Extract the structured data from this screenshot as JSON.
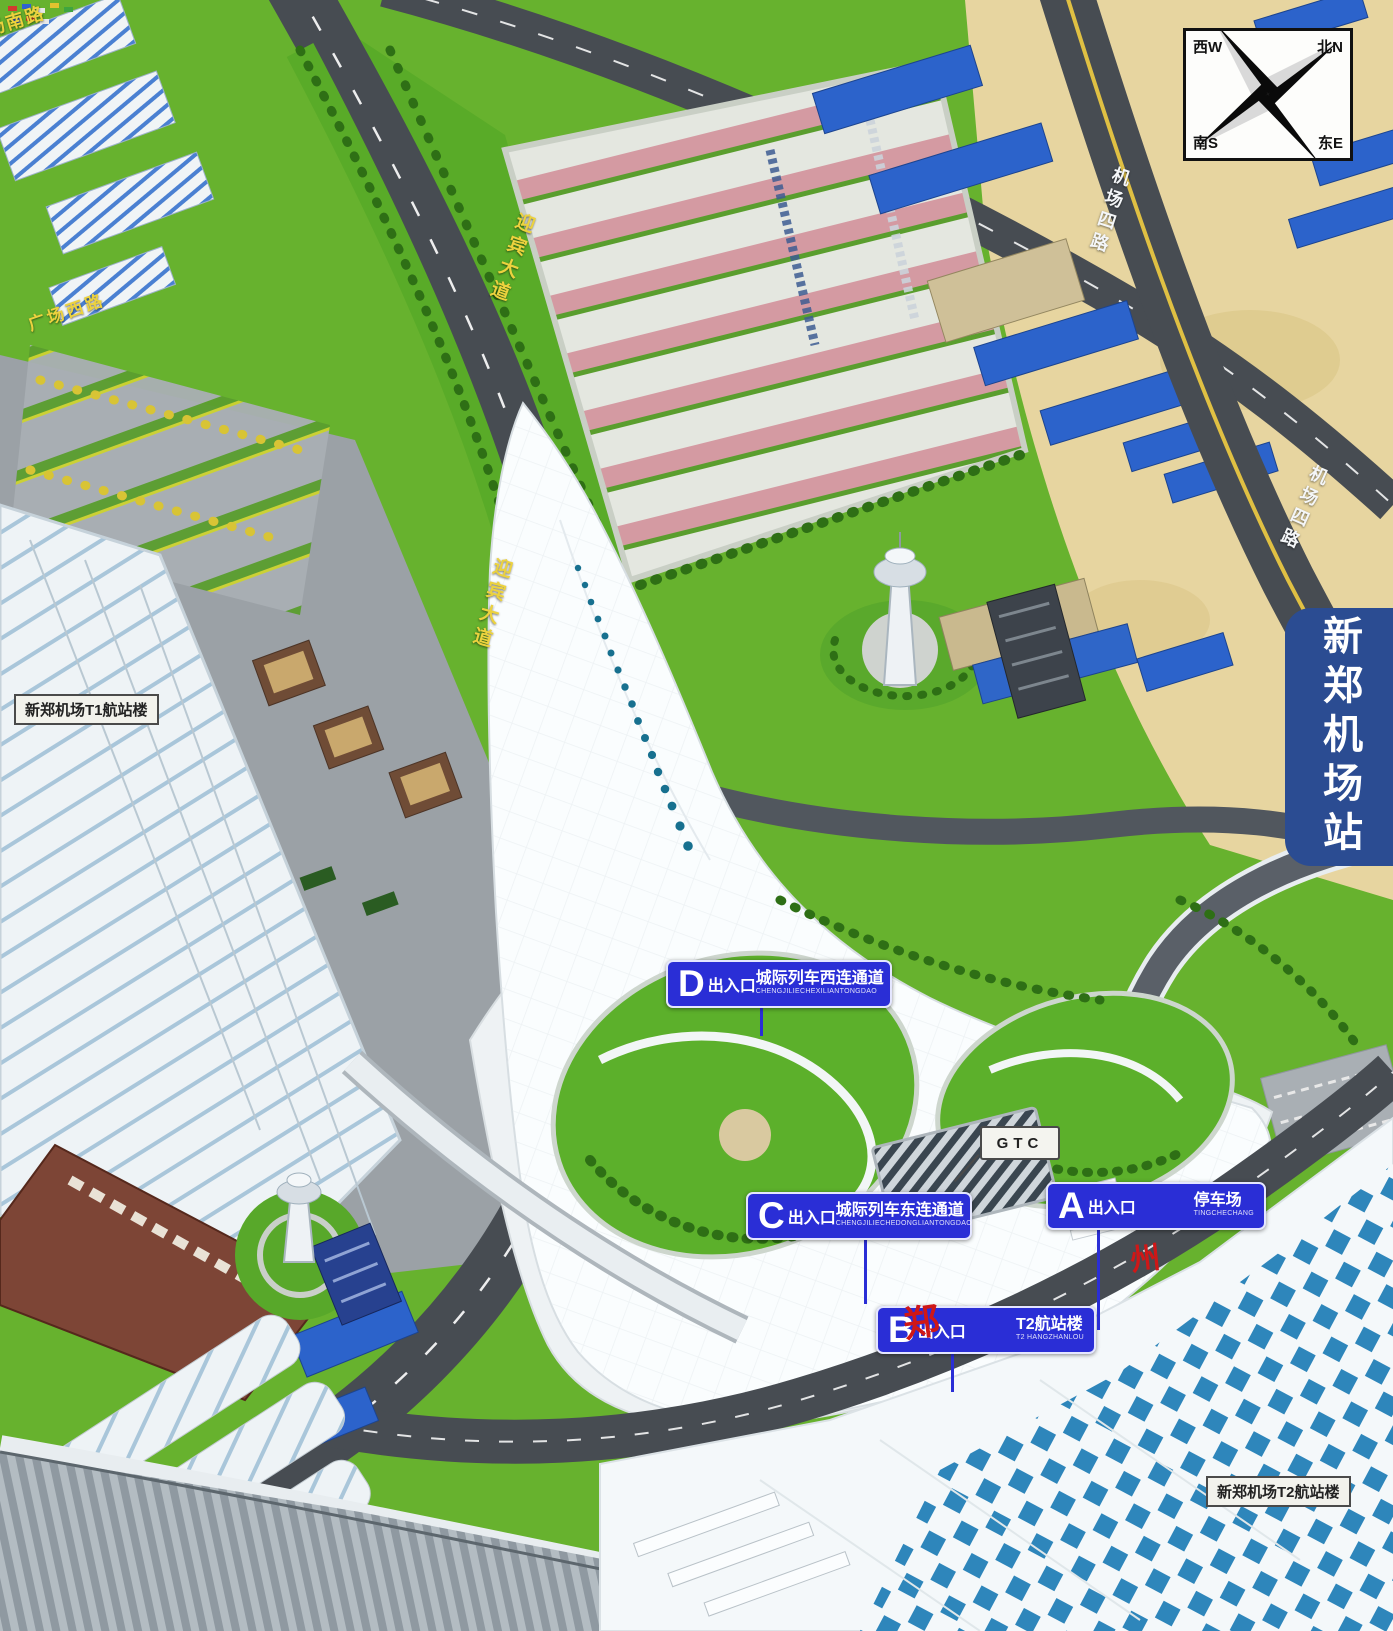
{
  "title": "新郑机场站",
  "compass": {
    "nw": "西W",
    "ne": "北N",
    "sw": "南S",
    "se": "东E"
  },
  "banner": {
    "label": "新郑机场站",
    "bg": "#2b4c92"
  },
  "terminal_labels": {
    "t1": "新郑机场T1航站楼",
    "t2": "新郑机场T2航站楼"
  },
  "gtc": {
    "label": "GTC"
  },
  "entrances": [
    {
      "letter": "D",
      "suffix": "出入口",
      "dest": "城际列车西连通道",
      "pinyin": "CHENGJILIECHEXILIANTONGDAO"
    },
    {
      "letter": "C",
      "suffix": "出入口",
      "dest": "城际列车东连通道",
      "pinyin": "CHENGJILIECHEDONGLIANTONGDAO"
    },
    {
      "letter": "B",
      "suffix": "出入口",
      "dest": "T2航站楼",
      "pinyin": "T2 HANGZHANLOU"
    },
    {
      "letter": "A",
      "suffix": "出入口",
      "dest": "停车场",
      "pinyin": "TINGCHECHANG"
    }
  ],
  "roads": {
    "guangchang_nan": "广场南路",
    "guangchang_xi": "广场西路",
    "yingbin": "迎宾大道",
    "jichang_si": "机场四路"
  },
  "seals": {
    "zheng": "郑",
    "zhou": "州"
  },
  "colors": {
    "entrance_blue": "#2a2ed6",
    "banner_blue": "#2b4c92",
    "road_label_yellow": "#ecd23e",
    "grass": "#67b22e",
    "sand": "#e7d5a0",
    "road_gray": "#474c52",
    "checker_blue": "#2e86bb"
  }
}
